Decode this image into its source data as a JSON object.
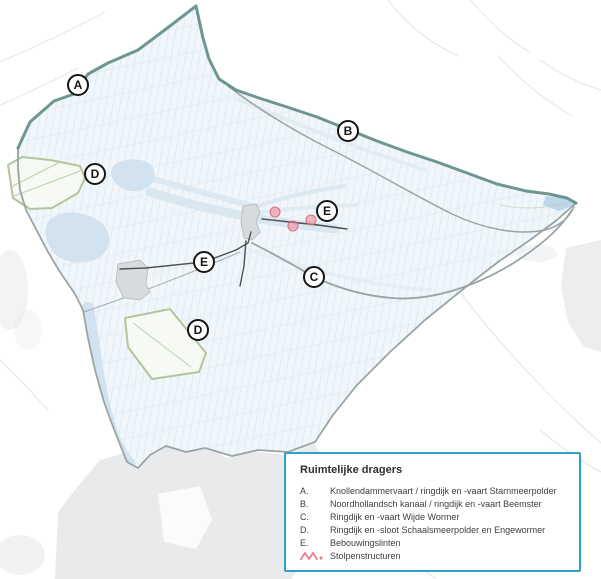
{
  "legend": {
    "title": "Ruimtelijke dragers",
    "items": [
      {
        "key": "A.",
        "label": "Knollendammervaart / ringdijk en -vaart Starnmeerpolder"
      },
      {
        "key": "B.",
        "label": "Noordhollandsch kanaal / ringdijk en -vaart Beemster"
      },
      {
        "key": "C.",
        "label": "Ringdijk en -vaart Wijde Wormer"
      },
      {
        "key": "D.",
        "label": "Ringdijk en -sloot Schaalsmeerpolder en Engewormer"
      },
      {
        "key": "E.",
        "label": "Bebouwingslinten"
      }
    ],
    "stolpen_label": "Stolpenstructuren"
  },
  "markers": [
    {
      "label": "A",
      "x": 78,
      "y": 85
    },
    {
      "label": "B",
      "x": 348,
      "y": 131
    },
    {
      "label": "D",
      "x": 95,
      "y": 174
    },
    {
      "label": "E",
      "x": 327,
      "y": 211
    },
    {
      "label": "E",
      "x": 204,
      "y": 262
    },
    {
      "label": "C",
      "x": 314,
      "y": 277
    },
    {
      "label": "D",
      "x": 198,
      "y": 330
    }
  ],
  "stolpen_points": [
    {
      "x": 275,
      "y": 212
    },
    {
      "x": 293,
      "y": 226
    },
    {
      "x": 311,
      "y": 220
    }
  ],
  "colors": {
    "c-teal": "#5e8c85",
    "c-gray-line": "#9aa4a4",
    "c-green": "#b4c59b",
    "c-water": "#d2e2ee",
    "c-water2": "#bcd6ea",
    "c-fill": "#f1f6fa",
    "c-parcel": "#dce8f2",
    "c-urban": "#e8eaeb",
    "c-village": "#d8dbdd",
    "c-village-line": "#b1b6b9",
    "c-lint": "#4b5154",
    "c-pink": "#ec8492",
    "c-pink-line": "#e05f72",
    "c-legend-border": "#2fa0c6",
    "c-text": "#3a3f42",
    "c-road": "#e3e6e8"
  }
}
